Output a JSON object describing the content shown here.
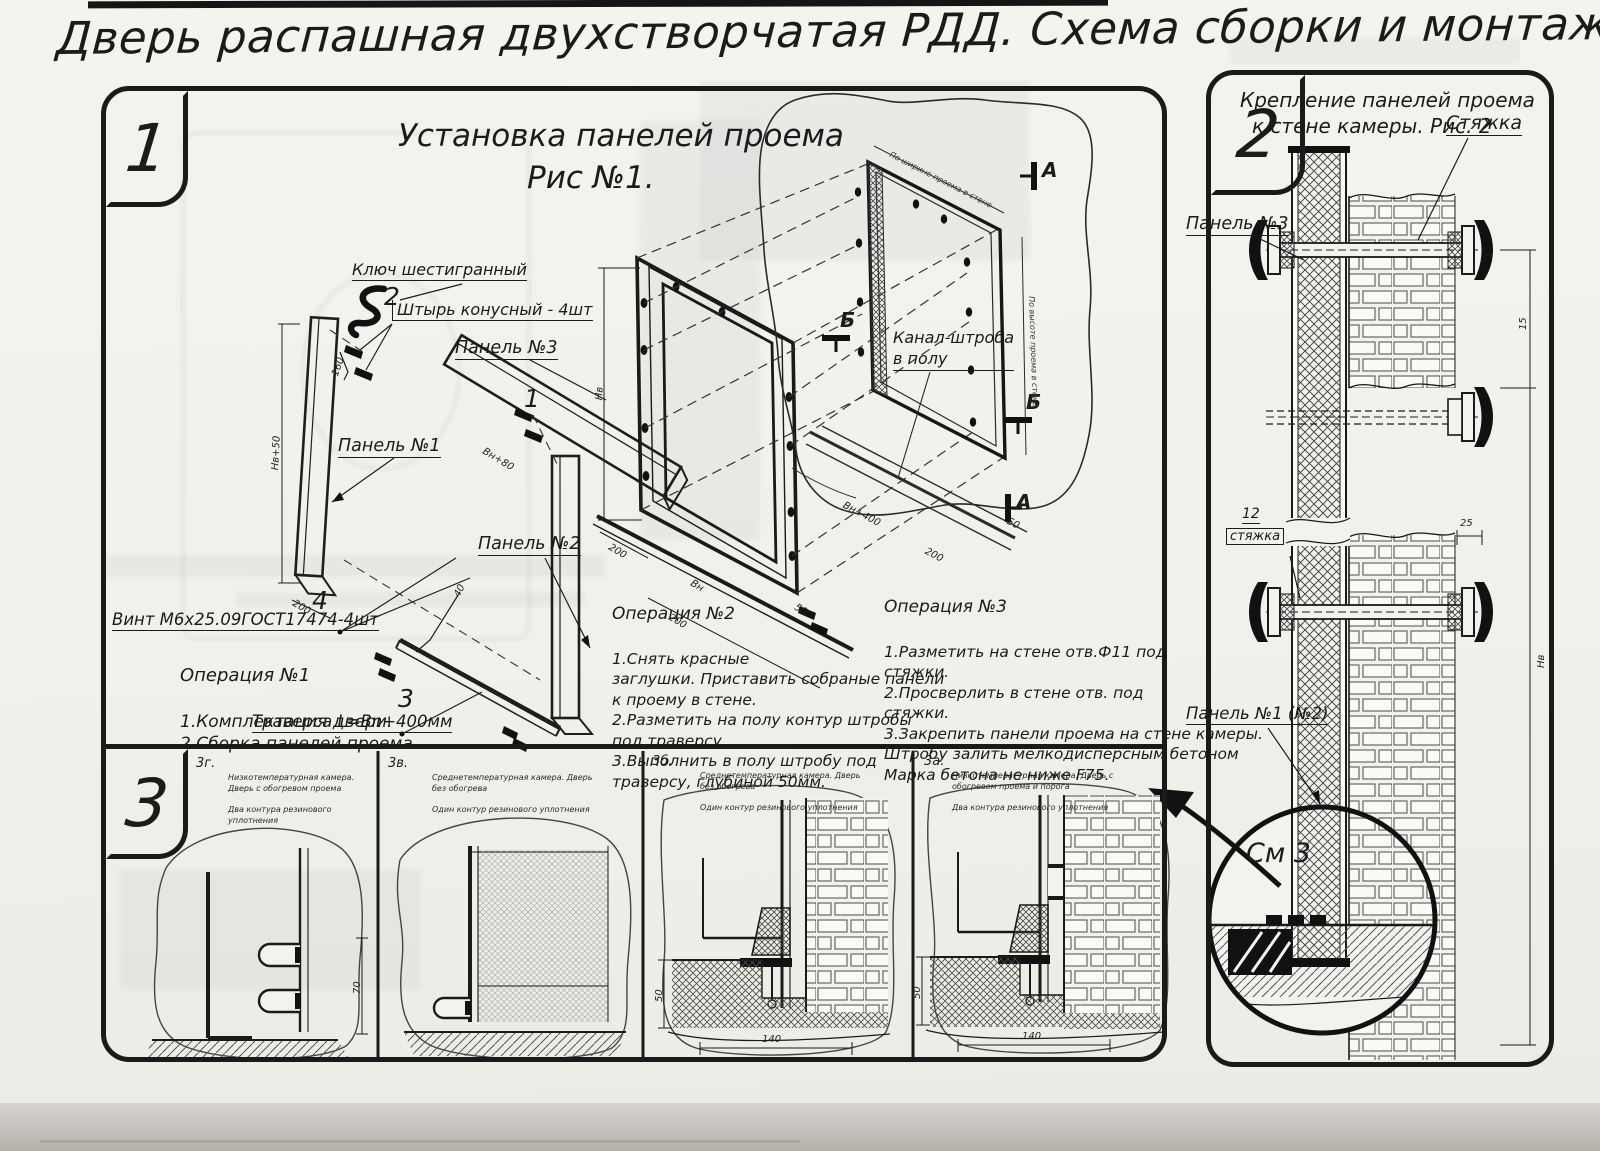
{
  "title": "Дверь распашная двухстворчатая РДД.  Схема сборки и монтажа №2",
  "fig1": {
    "badge": "1",
    "heading1": "Установка панелей проема",
    "heading2": "Рис №1.",
    "label_hex_key": "Ключ шестигранный",
    "label_pin": "Штырь конусный - 4шт",
    "label_panel3": "Панель №3",
    "label_panel1": "Панель №1",
    "label_panel2": "Панель №2",
    "label_screw": "Винт М6х25.09ГОСТ17474-4шт",
    "label_traverse": "Траверса  L=Bn+400мм",
    "label_channel": "Канал-штроба\nв полу",
    "callout_1": "1",
    "callout_2": "2",
    "callout_3": "3",
    "callout_4": "4",
    "section_a_top": "А",
    "section_a_bottom": "А",
    "section_b_left": "Б",
    "section_b_right": "Б",
    "dim_height_panel": "Нв+50",
    "dim_200a": "200",
    "dim_160": "160",
    "dim_40": "40",
    "dim_panel3_width": "Bн+80",
    "dim_frame_height": "Нв",
    "dim_frame_width": "Bн",
    "dim_200b": "200",
    "dim_200c": "200",
    "dim_50": "50",
    "dim_wall_width": "По ширине проема в стене",
    "dim_wall_height": "По высоте проема в стене",
    "dim_trav": "Bн+400",
    "dim_200d": "200",
    "dim_50b": "50",
    "op1_title": "Операция №1",
    "op1_body": "1.Комплектация двери.\n2.Сборка панелей проема",
    "op2_title": "Операция №2",
    "op2_body": "1.Снять красные\nзаглушки. Приставить собраные панели\nк проему в стене.\n2.Разметить на полу контур штробы\nпод траверсу.\n3.Выполнить в полу штробу под\nтраверсу, глубиной 50мм.",
    "op3_title": "Операция №3",
    "op3_body": "1.Разметить на стене отв.Ф11 под\nстяжки.\n2.Просверлить в стене отв.  под\nстяжки.\n3.Закрепить панели проема на стене камеры.\nШтробу залить мелкодисперсным бетоном\nМарка бетона не ниже  F75."
  },
  "fig2": {
    "badge": "2",
    "heading1": "Крепление панелей проема",
    "heading2": "к стене камеры. Рис. 2",
    "label_tie": "Стяжка",
    "label_panel3": "Панель №3",
    "label_pos12": "12",
    "label_pos12_name": "стяжка",
    "label_panel1": "Панель №1 (№2)",
    "label_see": "См 3",
    "dim_25": "25",
    "dim_15": "15",
    "dim_height": "Нв"
  },
  "fig3": {
    "badge": "3",
    "items": [
      {
        "id": "3г.",
        "line1": "Низкотемпературная камера. Дверь с обогревом проема",
        "line2": "Два контура резинового уплотнения"
      },
      {
        "id": "3в.",
        "line1": "Среднетемпературная камера. Дверь без обогрева",
        "line2": "Один контур резинового уплотнения"
      },
      {
        "id": "3б.",
        "line1": "Среднетемпературная камера. Дверь без обогрева",
        "line2": "Один контур резинового уплотнения"
      },
      {
        "id": "3а.",
        "line1": "Низкотемпературная камера. Дверь с обогревом проема и порога",
        "line2": "Два контура резинового уплотнения"
      }
    ],
    "dim_70": "70",
    "dim_50_b": "50",
    "dim_140_b": "140",
    "dim_50_a": "50",
    "dim_140_a": "140"
  }
}
